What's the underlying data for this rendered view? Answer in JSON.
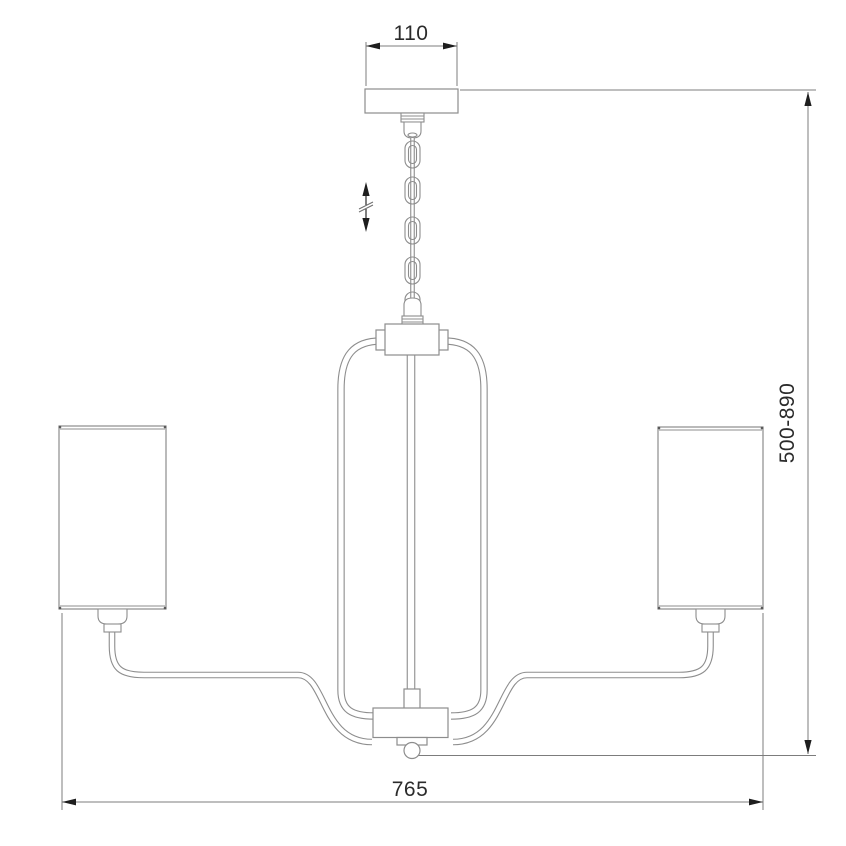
{
  "drawing": {
    "subject": "chandelier-dimension-diagram",
    "labels": {
      "canopy_width": "110",
      "height_range": "500-890",
      "overall_width": "765"
    },
    "symbols": {
      "height_adjust": "vertical-double-arrow-with-break"
    },
    "colors": {
      "background": "#ffffff",
      "outline": "#8d8d8d",
      "dimension_line": "#7c7c7c",
      "arrow_and_text": "#2b2b2b"
    }
  }
}
